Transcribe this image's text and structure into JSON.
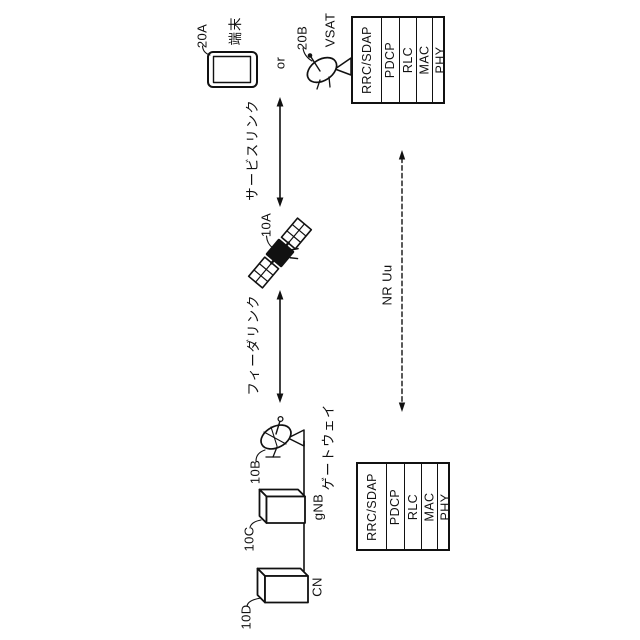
{
  "figure": {
    "type": "patent-network-diagram",
    "orientation": "rotated-90-ccw",
    "colors": {
      "ink": "#111111",
      "paper": "#ffffff"
    },
    "nodes": {
      "terminal": {
        "ref": "20A",
        "label": "端末"
      },
      "or_text": "or",
      "vsat": {
        "ref": "20B",
        "label": "VSAT"
      },
      "satellite": {
        "ref": "10A"
      },
      "gateway": {
        "ref": "10B",
        "label": "ゲートウェイ"
      },
      "gnb": {
        "ref": "10C",
        "label": "gNB"
      },
      "cn": {
        "ref": "10D",
        "label": "CN"
      }
    },
    "links": {
      "service_link": "サービスリンク",
      "feeder_link": "フィーダリンク",
      "nr_uu": "NR Uu"
    },
    "protocol_stack": {
      "layers": [
        "RRC/SDAP",
        "PDCP",
        "RLC",
        "MAC",
        "PHY"
      ]
    }
  }
}
